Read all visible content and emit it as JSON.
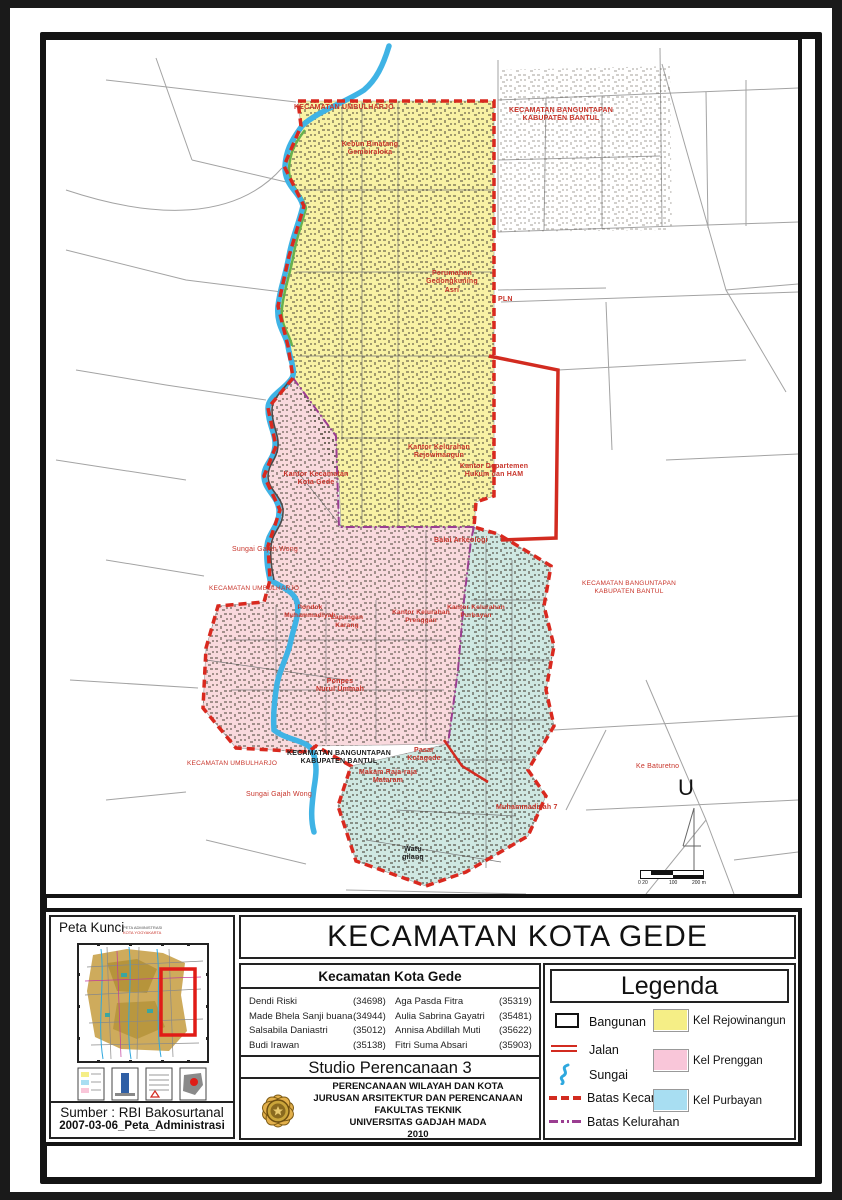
{
  "title_block": {
    "title": "KECAMATAN KOTA GEDE",
    "group_title": "Kecamatan Kota Gede",
    "students_left": [
      {
        "name": "Dendi Riski",
        "id": "(34698)"
      },
      {
        "name": "Made Bhela Sanji buana",
        "id": "(34944)"
      },
      {
        "name": "Salsabila Daniastri",
        "id": "(35012)"
      },
      {
        "name": "Budi Irawan",
        "id": "(35138)"
      }
    ],
    "students_right": [
      {
        "name": "Aga Pasda Fitra",
        "id": "(35319)"
      },
      {
        "name": "Aulia Sabrina Gayatri",
        "id": "(35481)"
      },
      {
        "name": "Annisa Abdillah Muti",
        "id": "(35622)"
      },
      {
        "name": "Fitri Suma Absari",
        "id": "(35903)"
      }
    ],
    "studio": "Studio Perencanaan 3",
    "institution": {
      "line1": "PERENCANAAN WILAYAH DAN KOTA",
      "line2": "JURUSAN ARSITEKTUR DAN PERENCANAAN",
      "line3": "FAKULTAS TEKNIK",
      "line4": "UNIVERSITAS GADJAH MADA",
      "line5": "2010"
    }
  },
  "legend": {
    "header": "Legenda",
    "items": {
      "bangunan": "Bangunan",
      "jalan": "Jalan",
      "sungai": "Sungai",
      "batas_kecamatan": "Batas Kecamatan",
      "batas_kelurahan": "Batas Kelurahan",
      "kel_rejowinangun": "Kel Rejowinangun",
      "kel_prenggan": "Kel Prenggan",
      "kel_purbayan": "Kel Purbayan"
    },
    "colors": {
      "rejowinangun": "#F5EE86",
      "prenggan": "#F9C6D9",
      "purbayan": "#A8DEF2",
      "jalan": "#D22B20",
      "batas_kecamatan": "#D9291F",
      "batas_kelurahan": "#9B3D91",
      "sungai": "#2FA8DE"
    }
  },
  "map_colors": {
    "rejowinangun": "#F8F2A4",
    "prenggan": "#F9D9DD",
    "purbayan": "#CFE8E2"
  },
  "key_map": {
    "title": "Peta Kunci",
    "subtitle1": "PETA ADMINISTRASI",
    "subtitle2": "KOTA YOGYAKARTA",
    "source": "Sumber : RBI Bakosurtanal",
    "filename": "2007-03-06_Peta_Administrasi"
  },
  "map": {
    "north": "U",
    "scale": {
      "a": "0 20",
      "b": "100",
      "c": "200 m"
    },
    "labels": [
      {
        "t": "KECAMATAN UMBULHARJO"
      },
      {
        "t": "KECAMATAN BANGUNTAPAN\nKABUPATEN BANTUL"
      },
      {
        "t": "Kebun Binatang\nGembiraloka"
      },
      {
        "t": "Perumahan\nGedongkuning\nAsri"
      },
      {
        "t": "PLN"
      },
      {
        "t": "Kantor Kelurahan\nRejowinangun"
      },
      {
        "t": "Kantor Departemen\nHukum dan HAM"
      },
      {
        "t": "Kantor Kecamatan\nKota Gede"
      },
      {
        "t": "Balai Arkeologi"
      },
      {
        "t": "Sungai Gajah Wong"
      },
      {
        "t": "KECAMATAN UMBULHARJO"
      },
      {
        "t": "KECAMATAN BANGUNTAPAN\nKABUPATEN BANTUL"
      },
      {
        "t": "Pondok\nMuhammadiyah"
      },
      {
        "t": "Lapangan\nKarang"
      },
      {
        "t": "Kantor Kelurahan\nPrenggan"
      },
      {
        "t": "Kantor Kelurahan\nPurbayan"
      },
      {
        "t": "Ponpes\nNurul Ummah"
      },
      {
        "t": "KECAMATAN BANGUNTAPAN\nKABUPATEN BANTUL"
      },
      {
        "t": "Pasar\nKotagede"
      },
      {
        "t": "Makam Raja-raja\nMataram"
      },
      {
        "t": "Muhammadiyah 7"
      },
      {
        "t": "KECAMATAN UMBULHARJO"
      },
      {
        "t": "Sungai Gajah Wong"
      },
      {
        "t": "Ke Baturetno"
      },
      {
        "t": "Watu\ngilang"
      }
    ]
  }
}
